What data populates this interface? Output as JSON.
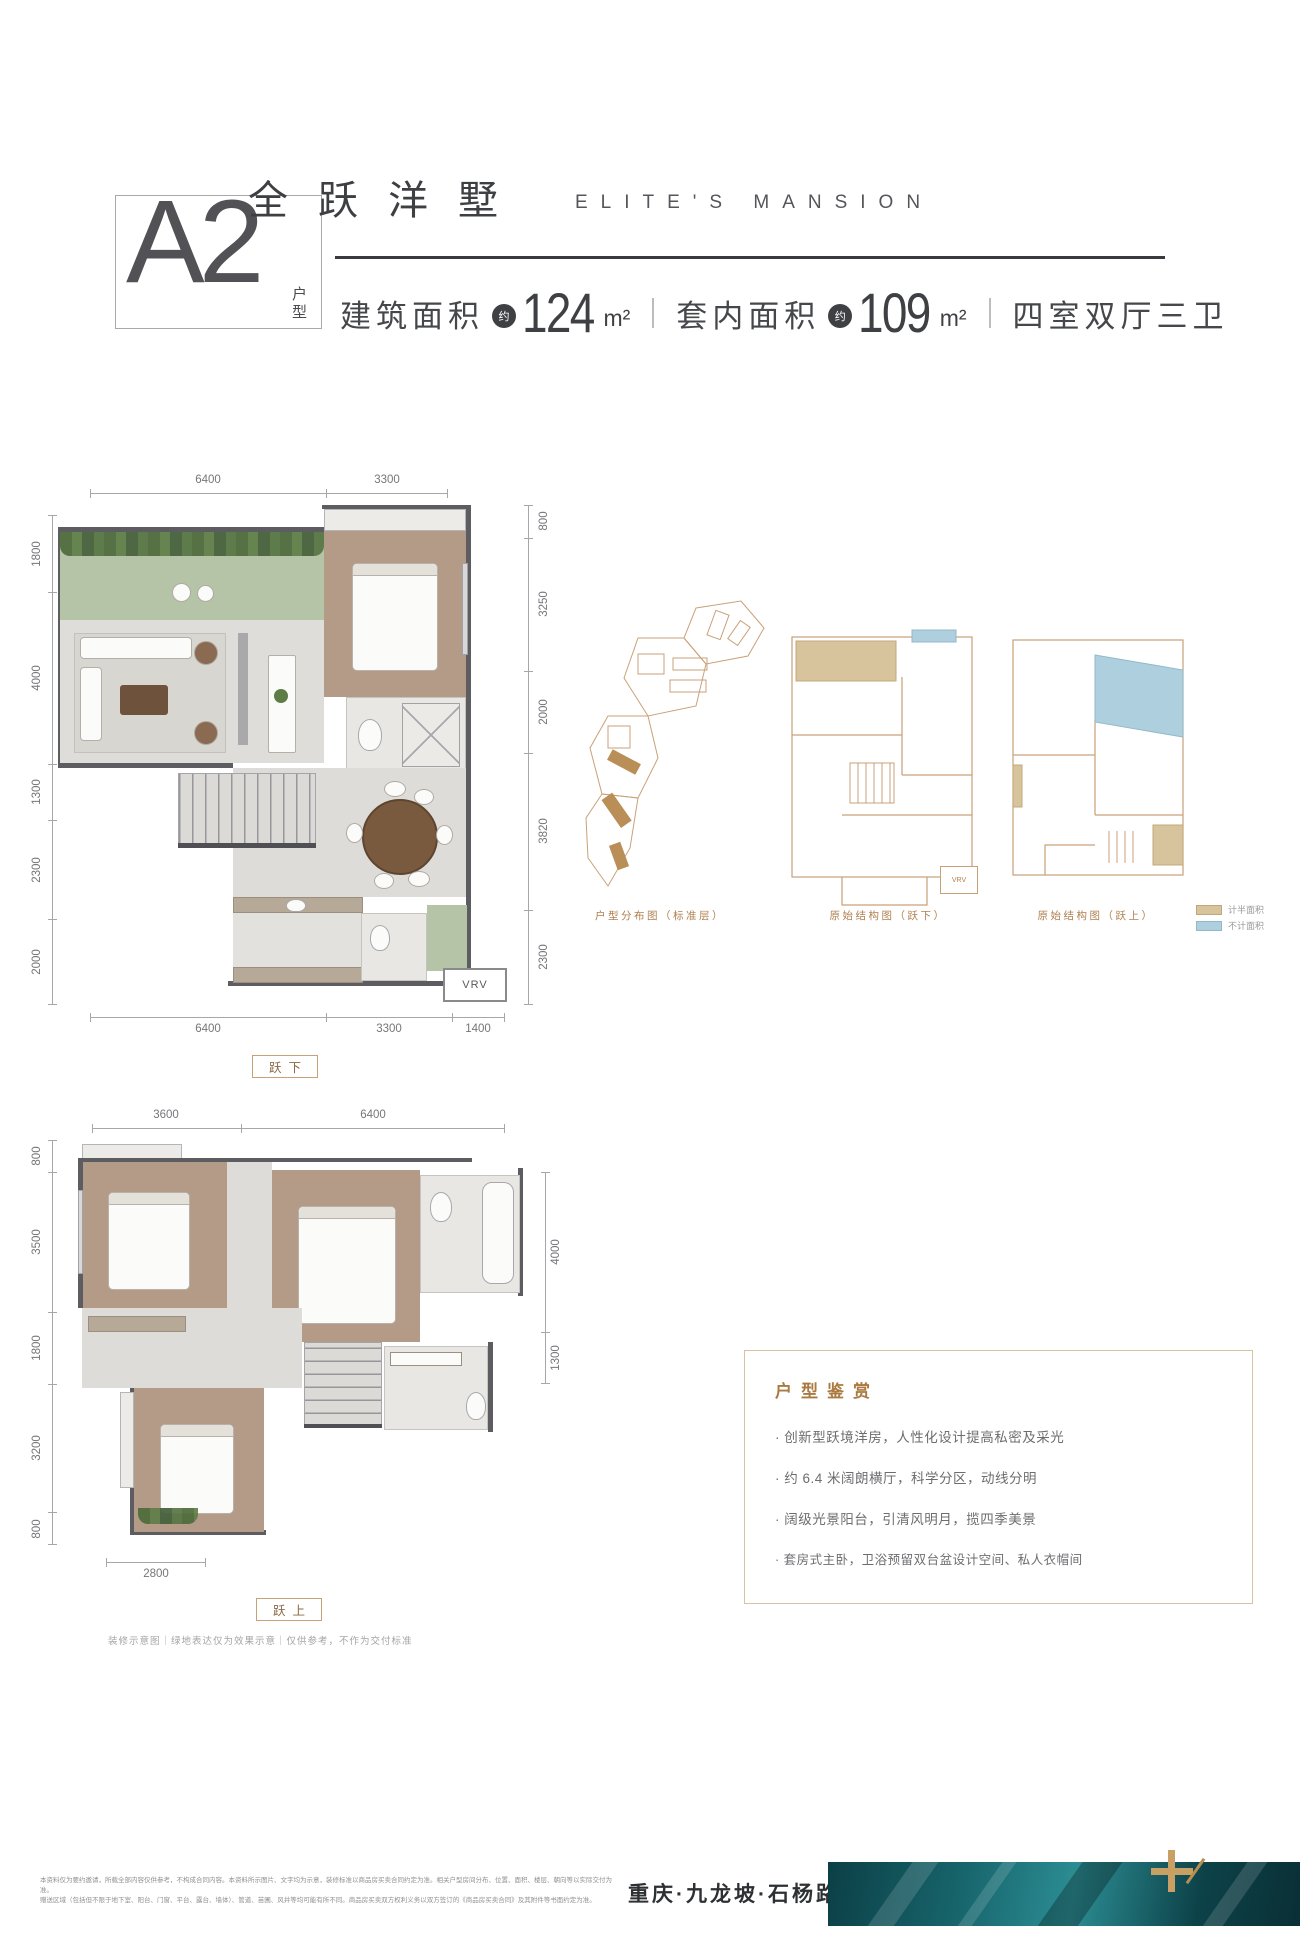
{
  "header": {
    "unit_code": "A2",
    "unit_label": "户型",
    "title_cn": "全跃洋墅",
    "title_en": "ELITE'S MANSION",
    "spec": {
      "area1_label": "建筑面积",
      "approx": "约",
      "area1_value": "124",
      "area1_unit": "m²",
      "area2_label": "套内面积",
      "area2_value": "109",
      "area2_unit": "m²",
      "rooms": "四室双厅三卫"
    }
  },
  "plan_lower": {
    "label": "跃下",
    "top_dims": [
      "6400",
      "3300"
    ],
    "left_dims": [
      "1800",
      "4000",
      "1300",
      "2300",
      "2000"
    ],
    "right_dims": [
      "800",
      "3250",
      "2000",
      "3820",
      "2300"
    ],
    "bottom_dims": [
      "6400",
      "3300",
      "1400"
    ],
    "vrv_label": "VRV"
  },
  "plan_upper": {
    "label": "跃上",
    "top_dims": [
      "3600",
      "6400"
    ],
    "left_dims": [
      "800",
      "3500",
      "1800",
      "3200",
      "800"
    ],
    "right_dims": [
      "4000",
      "1300"
    ],
    "bottom_dims": [
      "2800"
    ]
  },
  "diagrams": {
    "site_caption": "户型分布图（标准层）",
    "lower_caption": "原始结构图（跃下）",
    "upper_caption": "原始结构图（跃上）",
    "vrv_label": "VRV",
    "legend": [
      {
        "label": "计半面积",
        "color": "#d8c49c"
      },
      {
        "label": "不计面积",
        "color": "#aed0de"
      }
    ]
  },
  "appreciation": {
    "title": "户型鉴赏",
    "bullets": [
      "· 创新型跃境洋房，人性化设计提高私密及采光",
      "· 约 6.4 米阔朗横厅，科学分区，动线分明",
      "· 阔级光景阳台，引清风明月，揽四季美景",
      "· 套房式主卧，卫浴预留双台盆设计空间、私人衣帽间"
    ]
  },
  "notes": {
    "plan_note": "装修示意图｜绿地表达仅为效果示意｜仅供参考，不作为交付标准"
  },
  "footer": {
    "disclaimer_line1": "本资料仅为要约邀请，所载全部内容仅供参考，不构成合同内容。本资料所示图片、文字均为示意，装修标准以商品房买卖合同约定为准。相关户型房间分布、位置、面积、楼层、朝向等以实际交付为准。",
    "disclaimer_line2": "赠送区域（包括但不限于地下室、阳台、门窗、平台、露台、墙体）、管道、苗圃、风井等均可能有所不同。商品房买卖双方权利义务以双方签订的《商品房买卖合同》及其附件等书面约定为准。",
    "location": "重庆·九龙坡·石杨路"
  },
  "colors": {
    "accent_brown": "#b08050",
    "label_brown": "#8a6a45",
    "legend_tan": "#d8c49c",
    "legend_blue": "#aed0de",
    "teal_dark": "#0c3f46",
    "teal_mid": "#2b8d93",
    "gold": "#c9a063",
    "text_dark": "#3e3f43"
  }
}
